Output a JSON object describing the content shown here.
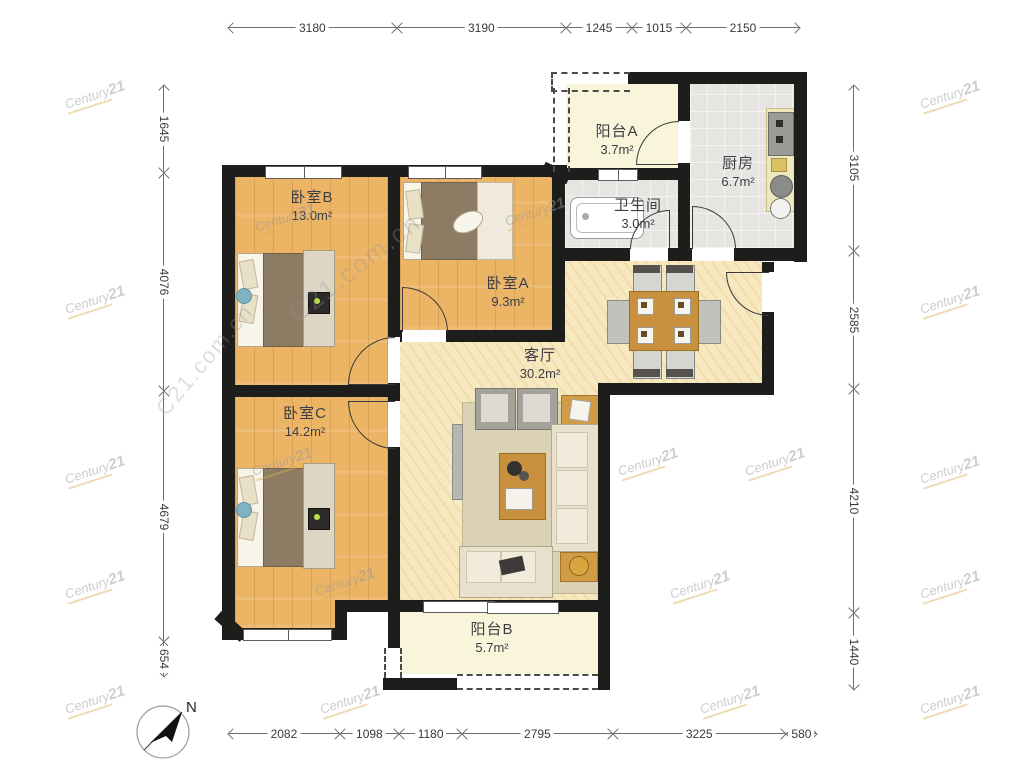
{
  "branding": {
    "watermark": "Century21",
    "watermark_domain": "C21.com.cn"
  },
  "compass": {
    "north_label": "N"
  },
  "rooms": [
    {
      "id": "balcony-a",
      "name": "阳台A",
      "area": "3.7m²"
    },
    {
      "id": "kitchen",
      "name": "厨房",
      "area": "6.7m²"
    },
    {
      "id": "bathroom",
      "name": "卫生间",
      "area": "3.0m²"
    },
    {
      "id": "bedroom-b",
      "name": "卧室B",
      "area": "13.0m²"
    },
    {
      "id": "bedroom-a",
      "name": "卧室A",
      "area": "9.3m²"
    },
    {
      "id": "living-room",
      "name": "客厅",
      "area": "30.2m²"
    },
    {
      "id": "bedroom-c",
      "name": "卧室C",
      "area": "14.2m²"
    },
    {
      "id": "balcony-b",
      "name": "阳台B",
      "area": "5.7m²"
    }
  ],
  "dimensions_mm": {
    "top": [
      3180,
      3190,
      1245,
      1015,
      2150
    ],
    "bottom": [
      2082,
      1098,
      1180,
      2795,
      3225,
      580
    ],
    "left": [
      1645,
      4076,
      4679,
      654
    ],
    "right": [
      3105,
      2585,
      4210,
      1440
    ]
  },
  "colors": {
    "wall": "#1d1d1b",
    "wood_floor": "#ecb566",
    "living_floor": "#f6e8bf",
    "balcony_floor": "#f8f5da",
    "tile_floor": "#e6e5e1",
    "accent_wood": "#c9913d"
  }
}
